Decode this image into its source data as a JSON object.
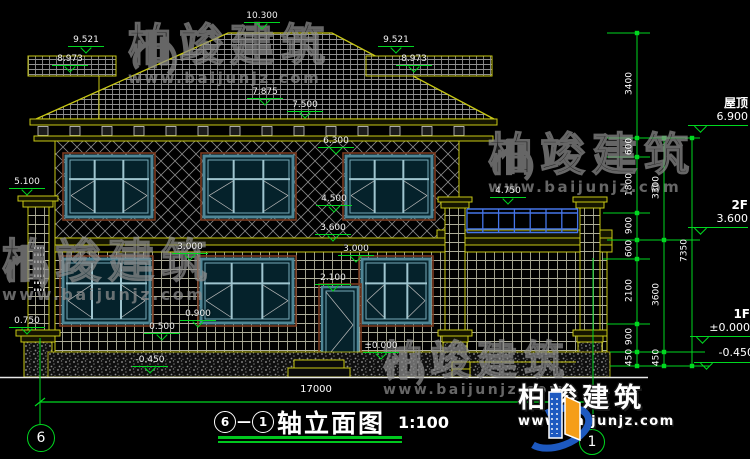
{
  "title": {
    "axis_from": "6",
    "dash": "—",
    "axis_to": "1",
    "name": "轴立面图",
    "scale": "1:100"
  },
  "axis_bubbles": {
    "left": "6",
    "right": "1"
  },
  "dims": {
    "total_width": "17000"
  },
  "levels": {
    "ridge": "10.300",
    "band_left_top": "9.521",
    "band_left_bottom": "8.973",
    "band_right_top": "9.521",
    "band_right_bottom": "8.973",
    "roof_edge": "7.875",
    "eave": "7.500",
    "window2_top": "6.300",
    "pillar_top": "5.100",
    "railing_top": "4.750",
    "window2_sill": "4.500",
    "floor2": "3.600",
    "window1_top_left": "3.000",
    "window1_top_right": "3.000",
    "door_top": "2.100",
    "window1_sill": "0.900",
    "pillar_base": "0.750",
    "plinth_step": "0.500",
    "ground_zero": "±0.000",
    "ground_below": "-0.450"
  },
  "right_dims": {
    "inner": [
      "450",
      "900",
      "2100",
      "600",
      "900",
      "1800",
      "600",
      "3400"
    ],
    "middle": [
      "450",
      "3600",
      "3300"
    ],
    "outer": [
      "7350"
    ]
  },
  "floor_levels": {
    "roof_label": "屋顶",
    "roof_value": "6.900",
    "f2_label": "2F",
    "f2_value": "3.600",
    "f1_label": "1F",
    "f1_value": "±0.000",
    "below_value": "-0.450"
  },
  "watermark": {
    "brand": "柏竣建筑",
    "url": "www.baijunjz.com"
  },
  "logo": {
    "brand": "柏竣建筑",
    "url": "www.baijunjz.com"
  }
}
